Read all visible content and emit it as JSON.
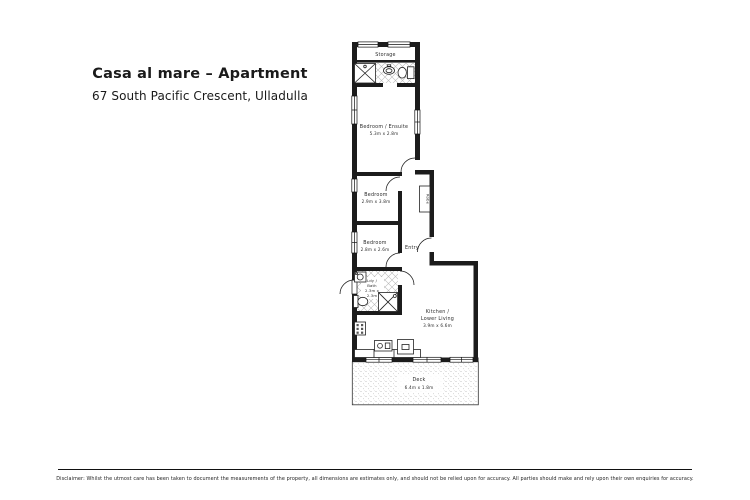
{
  "header": {
    "title": "Casa al mare – Apartment",
    "address": "67 South Pacific Crescent, Ulladulla"
  },
  "floorplan": {
    "storage": {
      "label": "Storage"
    },
    "bedroom_ensuite": {
      "label": "Bedroom / Ensuite",
      "dims": "5.3m x 2.8m"
    },
    "bedroom_mid": {
      "label": "Bedroom",
      "dims": "2.9m x 3.8m"
    },
    "bedroom_lower": {
      "label": "Bedroom",
      "dims": "2.8m x 2.6m"
    },
    "entry": {
      "label": "Entry"
    },
    "robe": {
      "label": "Robe"
    },
    "laundry_bath": {
      "label_line1": "Ldy /",
      "label_line2": "Bath",
      "dims_line1": "2.3m x",
      "dims_line2": "2.3m"
    },
    "kitchen_living": {
      "label_line1": "Kitchen /",
      "label_line2": "Lower Living",
      "dims": "3.9m x 6.6m"
    },
    "deck": {
      "label": "Deck",
      "dims": "6.4m x 1.8m"
    },
    "colors": {
      "wall": "#1c1c1c",
      "hatch": "#b8b8b8",
      "deck_stipple": "#999999"
    }
  },
  "footer": {
    "disclaimer": "Disclaimer: Whilst the utmost care has been taken to document the measurements of the property, all dimensions are estimates only, and should not be relied upon for accuracy.  All parties should make and rely upon their own enquiries for accuracy."
  }
}
